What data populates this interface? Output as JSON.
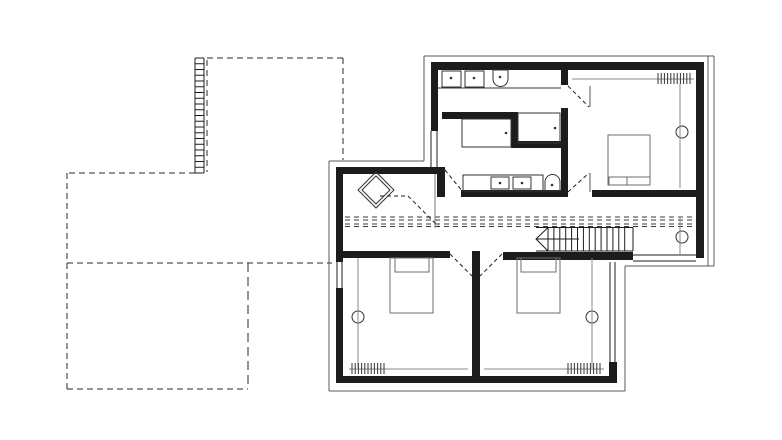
{
  "meta": {
    "content_type": "architectural-floor-plan",
    "description": "upper-storey plan, black ink line drawing on white; no text labels visible"
  },
  "canvas": {
    "width": 782,
    "height": 440,
    "background": "#ffffff",
    "ink": "#1c1c1c"
  },
  "drawing": {
    "ink": "#1c1c1c",
    "groups": [
      {
        "name": "lower-floor-outline",
        "c": "#2a2a2a",
        "items": [
          {
            "t": "line",
            "x1": 207,
            "y1": 58,
            "x2": 343,
            "y2": 58,
            "d": "6 4"
          },
          {
            "t": "line",
            "x1": 343,
            "y1": 58,
            "x2": 343,
            "y2": 160,
            "d": "6 4"
          },
          {
            "t": "line",
            "x1": 207,
            "y1": 60,
            "x2": 207,
            "y2": 172,
            "d": "6 4"
          },
          {
            "t": "line",
            "x1": 195,
            "y1": 173,
            "x2": 67,
            "y2": 173,
            "d": "6 4"
          },
          {
            "t": "line",
            "x1": 67,
            "y1": 173,
            "x2": 67,
            "y2": 389,
            "d": "6 4"
          },
          {
            "t": "line",
            "x1": 67,
            "y1": 263,
            "x2": 332,
            "y2": 263,
            "d": "6 4"
          },
          {
            "t": "line",
            "x1": 67,
            "y1": 389,
            "x2": 248,
            "y2": 389,
            "d": "6 4"
          },
          {
            "t": "line",
            "x1": 248,
            "y1": 263,
            "x2": 248,
            "y2": 389,
            "d": "9 5"
          }
        ]
      },
      {
        "name": "trellis-band",
        "items": [
          {
            "t": "line",
            "x1": 195,
            "y1": 58,
            "x2": 195,
            "y2": 173
          },
          {
            "t": "line",
            "x1": 204,
            "y1": 58,
            "x2": 204,
            "y2": 173
          },
          {
            "t": "hhatch",
            "x1": 195,
            "x2": 204,
            "y1": 58,
            "y2": 173,
            "step": 5.75
          }
        ]
      },
      {
        "name": "roof-overhang-outline",
        "c": "#5a5a5a",
        "items": [
          {
            "t": "line",
            "x1": 424,
            "y1": 56,
            "x2": 714,
            "y2": 56
          },
          {
            "t": "line",
            "x1": 708,
            "y1": 56,
            "x2": 708,
            "y2": 266
          },
          {
            "t": "line",
            "x1": 714,
            "y1": 56,
            "x2": 714,
            "y2": 266
          },
          {
            "t": "line",
            "x1": 625,
            "y1": 266,
            "x2": 714,
            "y2": 266
          },
          {
            "t": "line",
            "x1": 625,
            "y1": 266,
            "x2": 625,
            "y2": 391
          },
          {
            "t": "line",
            "x1": 329,
            "y1": 391,
            "x2": 625,
            "y2": 391
          },
          {
            "t": "line",
            "x1": 329,
            "y1": 161,
            "x2": 329,
            "y2": 391
          },
          {
            "t": "line",
            "x1": 329,
            "y1": 161,
            "x2": 424,
            "y2": 161
          },
          {
            "t": "line",
            "x1": 424,
            "y1": 56,
            "x2": 424,
            "y2": 161
          }
        ]
      },
      {
        "name": "exterior-walls",
        "items": [
          {
            "t": "rect",
            "x": 431,
            "y": 62,
            "w": 272,
            "h": 8,
            "f": true
          },
          {
            "t": "rect",
            "x": 696,
            "y": 62,
            "w": 8,
            "h": 196,
            "f": true
          },
          {
            "t": "rect",
            "x": 431,
            "y": 62,
            "w": 7,
            "h": 69,
            "f": true
          },
          {
            "t": "rect",
            "x": 437,
            "y": 168,
            "w": 8,
            "h": 29,
            "f": true
          },
          {
            "t": "rect",
            "x": 592,
            "y": 190,
            "w": 104,
            "h": 7,
            "f": true
          },
          {
            "t": "rect",
            "x": 336,
            "y": 167,
            "w": 109,
            "h": 7,
            "f": true
          },
          {
            "t": "rect",
            "x": 336,
            "y": 167,
            "w": 7,
            "h": 95,
            "f": true
          },
          {
            "t": "rect",
            "x": 336,
            "y": 288,
            "w": 7,
            "h": 95,
            "f": true
          },
          {
            "t": "rect",
            "x": 336,
            "y": 376,
            "w": 281,
            "h": 7,
            "f": true
          },
          {
            "t": "rect",
            "x": 609,
            "y": 362,
            "w": 8,
            "h": 21,
            "f": true
          },
          {
            "t": "rect",
            "x": 336,
            "y": 251,
            "w": 114,
            "h": 7,
            "f": true
          },
          {
            "t": "rect",
            "x": 503,
            "y": 252,
            "w": 130,
            "h": 8,
            "f": true
          },
          {
            "t": "rect",
            "x": 472,
            "y": 251,
            "w": 8,
            "h": 132,
            "f": true
          }
        ]
      },
      {
        "name": "interior-walls",
        "items": [
          {
            "t": "rect",
            "x": 442,
            "y": 112,
            "w": 70,
            "h": 7,
            "f": true
          },
          {
            "t": "rect",
            "x": 511,
            "y": 112,
            "w": 7,
            "h": 36,
            "f": true
          },
          {
            "t": "rect",
            "x": 511,
            "y": 141,
            "w": 57,
            "h": 7,
            "f": true
          },
          {
            "t": "rect",
            "x": 561,
            "y": 62,
            "w": 7,
            "h": 23,
            "f": true
          },
          {
            "t": "rect",
            "x": 561,
            "y": 108,
            "w": 7,
            "h": 89,
            "f": true
          },
          {
            "t": "rect",
            "x": 461,
            "y": 190,
            "w": 107,
            "h": 7,
            "f": true
          }
        ]
      },
      {
        "name": "windows",
        "items": [
          {
            "t": "line",
            "x1": 431,
            "y1": 131,
            "x2": 431,
            "y2": 168
          },
          {
            "t": "line",
            "x1": 437,
            "y1": 131,
            "x2": 437,
            "y2": 168
          },
          {
            "t": "line",
            "x1": 337,
            "y1": 262,
            "x2": 337,
            "y2": 288
          },
          {
            "t": "line",
            "x1": 342,
            "y1": 262,
            "x2": 342,
            "y2": 288
          },
          {
            "t": "line",
            "x1": 610,
            "y1": 262,
            "x2": 610,
            "y2": 362
          },
          {
            "t": "line",
            "x1": 615,
            "y1": 262,
            "x2": 615,
            "y2": 362
          },
          {
            "t": "line",
            "x1": 633,
            "y1": 255,
            "x2": 696,
            "y2": 255
          },
          {
            "t": "line",
            "x1": 633,
            "y1": 261,
            "x2": 696,
            "y2": 261
          }
        ]
      },
      {
        "name": "corridor-guide-lines",
        "c": "#3a3a3a",
        "items": [
          {
            "t": "line",
            "x1": 345,
            "y1": 217,
            "x2": 695,
            "y2": 217,
            "d": "5 4"
          },
          {
            "t": "line",
            "x1": 345,
            "y1": 220,
            "x2": 695,
            "y2": 220,
            "d": "5 4"
          },
          {
            "t": "line",
            "x1": 345,
            "y1": 224,
            "x2": 695,
            "y2": 224,
            "d": "5 4"
          },
          {
            "t": "line",
            "x1": 345,
            "y1": 226.5,
            "x2": 695,
            "y2": 226.5,
            "d": "5 4"
          }
        ]
      },
      {
        "name": "staircase",
        "items": [
          {
            "t": "line",
            "x1": 536,
            "y1": 227.5,
            "x2": 633,
            "y2": 227.5
          },
          {
            "t": "line",
            "x1": 536,
            "y1": 251,
            "x2": 633,
            "y2": 251
          },
          {
            "t": "line",
            "x1": 633,
            "y1": 227.5,
            "x2": 633,
            "y2": 251
          },
          {
            "t": "vhatch",
            "x1": 548,
            "x2": 630,
            "y1": 227.5,
            "y2": 251,
            "step": 5.9
          },
          {
            "t": "pl",
            "pts": [
              [
                548,
                227.5
              ],
              [
                536,
                239
              ],
              [
                548,
                251
              ]
            ]
          },
          {
            "t": "line",
            "x1": 536,
            "y1": 239,
            "x2": 579,
            "y2": 239
          }
        ]
      },
      {
        "name": "skylight-diamond",
        "c": "#333333",
        "items": [
          {
            "t": "poly",
            "pts": [
              [
                376,
                172
              ],
              [
                394,
                190
              ],
              [
                376,
                208
              ],
              [
                358,
                190
              ]
            ]
          },
          {
            "t": "poly",
            "pts": [
              [
                376,
                176
              ],
              [
                390,
                190
              ],
              [
                376,
                204
              ],
              [
                362,
                190
              ]
            ]
          }
        ]
      },
      {
        "name": "hall-partition-line",
        "c": "#777777",
        "items": [
          {
            "t": "line",
            "x1": 435,
            "y1": 174,
            "x2": 435,
            "y2": 228
          }
        ]
      },
      {
        "name": "bathroom-top-fixtures",
        "c": "#333333",
        "items": [
          {
            "t": "line",
            "x1": 438,
            "y1": 88,
            "x2": 561,
            "y2": 88
          },
          {
            "t": "rect",
            "x": 442,
            "y": 71,
            "w": 19,
            "h": 16
          },
          {
            "t": "dot",
            "cx": 451,
            "cy": 78
          },
          {
            "t": "rect",
            "x": 465,
            "y": 71,
            "w": 19,
            "h": 16
          },
          {
            "t": "dot",
            "cx": 474,
            "cy": 78
          },
          {
            "t": "path",
            "dd": "M493 70 h15 v9 a7.5 7.5 0 0 1 -15 0 z"
          },
          {
            "t": "dot",
            "cx": 500,
            "cy": 77
          },
          {
            "t": "rect",
            "x": 462,
            "y": 119,
            "w": 49,
            "h": 28
          },
          {
            "t": "dot",
            "cx": 506,
            "cy": 133
          },
          {
            "t": "rect",
            "x": 518,
            "y": 113,
            "w": 42,
            "h": 30
          },
          {
            "t": "dot",
            "cx": 555,
            "cy": 128
          }
        ]
      },
      {
        "name": "bathroom-bottom-fixtures",
        "c": "#333333",
        "items": [
          {
            "t": "rect",
            "x": 463,
            "y": 175,
            "w": 80,
            "h": 16
          },
          {
            "t": "rect",
            "x": 491,
            "y": 177,
            "w": 18,
            "h": 12
          },
          {
            "t": "dot",
            "cx": 500,
            "cy": 183
          },
          {
            "t": "rect",
            "x": 513,
            "y": 177,
            "w": 18,
            "h": 12
          },
          {
            "t": "dot",
            "cx": 522,
            "cy": 183
          },
          {
            "t": "path",
            "dd": "M545 191 v-9 a7.5 7.5 0 0 1 15 0 v9 z"
          },
          {
            "t": "dot",
            "cx": 552,
            "cy": 185
          }
        ]
      },
      {
        "name": "door-swings",
        "items": [
          {
            "t": "line",
            "x1": 445,
            "y1": 170,
            "x2": 463,
            "y2": 192,
            "d": "4 3"
          },
          {
            "t": "line",
            "x1": 380,
            "y1": 196,
            "x2": 408,
            "y2": 196,
            "d": "4 3"
          },
          {
            "t": "line",
            "x1": 408,
            "y1": 196,
            "x2": 439,
            "y2": 227,
            "d": "4 3"
          },
          {
            "t": "line",
            "x1": 568,
            "y1": 86,
            "x2": 589,
            "y2": 107,
            "d": "4 3"
          },
          {
            "t": "line",
            "x1": 590,
            "y1": 86,
            "x2": 590,
            "y2": 107,
            "c": "#555555"
          },
          {
            "t": "line",
            "x1": 568,
            "y1": 192,
            "x2": 589,
            "y2": 173,
            "d": "4 3"
          },
          {
            "t": "line",
            "x1": 590,
            "y1": 173,
            "x2": 590,
            "y2": 192,
            "c": "#555555"
          },
          {
            "t": "line",
            "x1": 450,
            "y1": 254,
            "x2": 472,
            "y2": 276,
            "d": "4 3"
          },
          {
            "t": "line",
            "x1": 502,
            "y1": 254,
            "x2": 480,
            "y2": 276,
            "d": "4 3"
          }
        ]
      },
      {
        "name": "beds",
        "c": "#6e6e6e",
        "items": [
          {
            "t": "rect",
            "x": 390,
            "y": 258,
            "w": 43,
            "h": 55
          },
          {
            "t": "pl",
            "pts": [
              [
                395,
                258
              ],
              [
                395,
                272
              ],
              [
                429,
                272
              ],
              [
                429,
                258
              ]
            ]
          },
          {
            "t": "rect",
            "x": 517,
            "y": 258,
            "w": 43,
            "h": 55
          },
          {
            "t": "pl",
            "pts": [
              [
                521,
                258
              ],
              [
                521,
                272
              ],
              [
                556,
                272
              ],
              [
                556,
                258
              ]
            ]
          },
          {
            "t": "rect",
            "x": 608,
            "y": 135,
            "w": 42,
            "h": 50
          },
          {
            "t": "line",
            "x1": 608,
            "y1": 177,
            "x2": 650,
            "y2": 177
          },
          {
            "t": "pl",
            "pts": [
              [
                609,
                177
              ],
              [
                609,
                185
              ],
              [
                627,
                185
              ],
              [
                627,
                177
              ]
            ]
          }
        ]
      },
      {
        "name": "ceiling-lamps",
        "c": "#333333",
        "items": [
          {
            "t": "circle",
            "cx": 682,
            "cy": 132,
            "r": 6
          },
          {
            "t": "circle",
            "cx": 682,
            "cy": 237,
            "r": 6
          },
          {
            "t": "circle",
            "cx": 358,
            "cy": 317,
            "r": 6
          },
          {
            "t": "circle",
            "cx": 592,
            "cy": 317,
            "r": 6
          }
        ]
      },
      {
        "name": "beam-lines",
        "c": "#8a8a8a",
        "items": [
          {
            "t": "line",
            "x1": 680,
            "y1": 84,
            "x2": 680,
            "y2": 188
          },
          {
            "t": "line",
            "x1": 680,
            "y1": 218,
            "x2": 680,
            "y2": 256
          },
          {
            "t": "line",
            "x1": 358,
            "y1": 258,
            "x2": 358,
            "y2": 368
          },
          {
            "t": "line",
            "x1": 592,
            "y1": 258,
            "x2": 592,
            "y2": 368
          }
        ]
      },
      {
        "name": "radiators",
        "c": "#333333",
        "items": [
          {
            "t": "line",
            "x1": 572,
            "y1": 79,
            "x2": 694,
            "y2": 79,
            "c": "#8a8a8a"
          },
          {
            "t": "vhatch",
            "x1": 658,
            "x2": 690,
            "y1": 73,
            "y2": 84,
            "step": 3.2
          },
          {
            "t": "line",
            "x1": 349,
            "y1": 369,
            "x2": 468,
            "y2": 369,
            "c": "#8a8a8a"
          },
          {
            "t": "vhatch",
            "x1": 352,
            "x2": 384,
            "y1": 363,
            "y2": 374,
            "step": 3.2
          },
          {
            "t": "line",
            "x1": 484,
            "y1": 369,
            "x2": 604,
            "y2": 369,
            "c": "#8a8a8a"
          },
          {
            "t": "vhatch",
            "x1": 568,
            "x2": 600,
            "y1": 363,
            "y2": 374,
            "step": 3.2
          }
        ]
      }
    ]
  }
}
